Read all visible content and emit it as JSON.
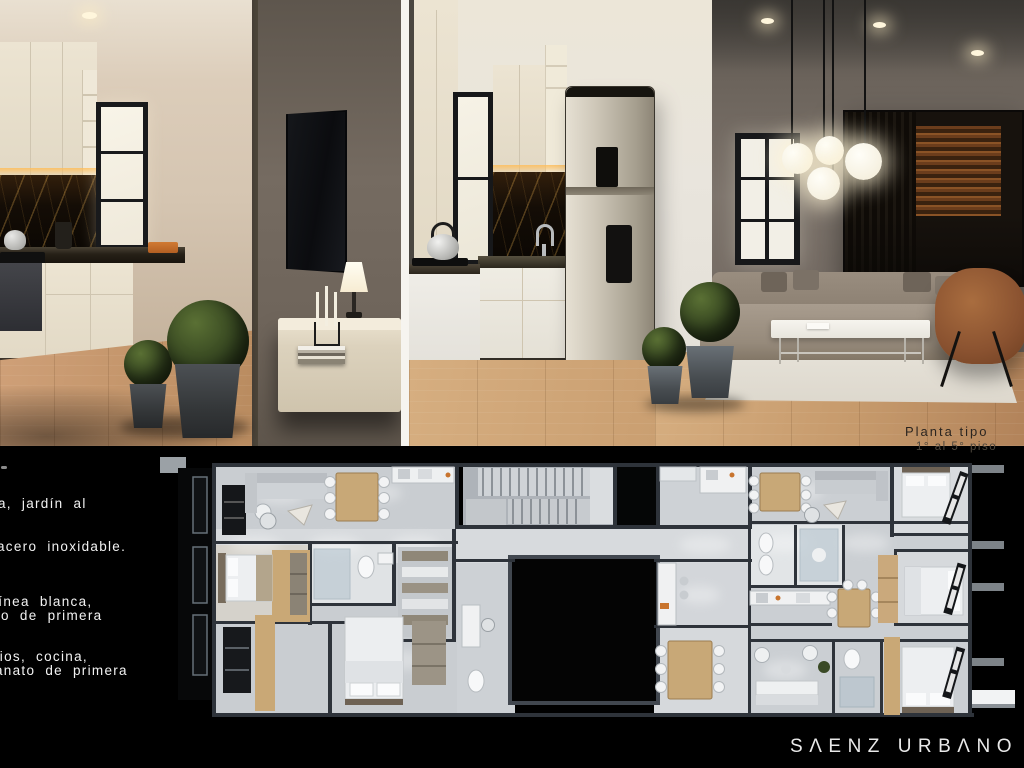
{
  "colors": {
    "background": "#000000",
    "notes_text": "#f2f2f2",
    "brand_text": "#e9e9e9",
    "plan_title_text": "#2b2520",
    "plan_accent_orange": "#c8742e"
  },
  "notes": {
    "lines": [
      "a, jardín al",
      "acero inoxidable.",
      "línea blanca,",
      "co de primera",
      "rios, cocina,",
      "anato de primera"
    ]
  },
  "plan": {
    "title": "Planta tipo",
    "subtitle": "1° al 5° piso"
  },
  "brand": {
    "label": "SAENZ URBANO",
    "display": "SΛENZ URBΛNO"
  }
}
